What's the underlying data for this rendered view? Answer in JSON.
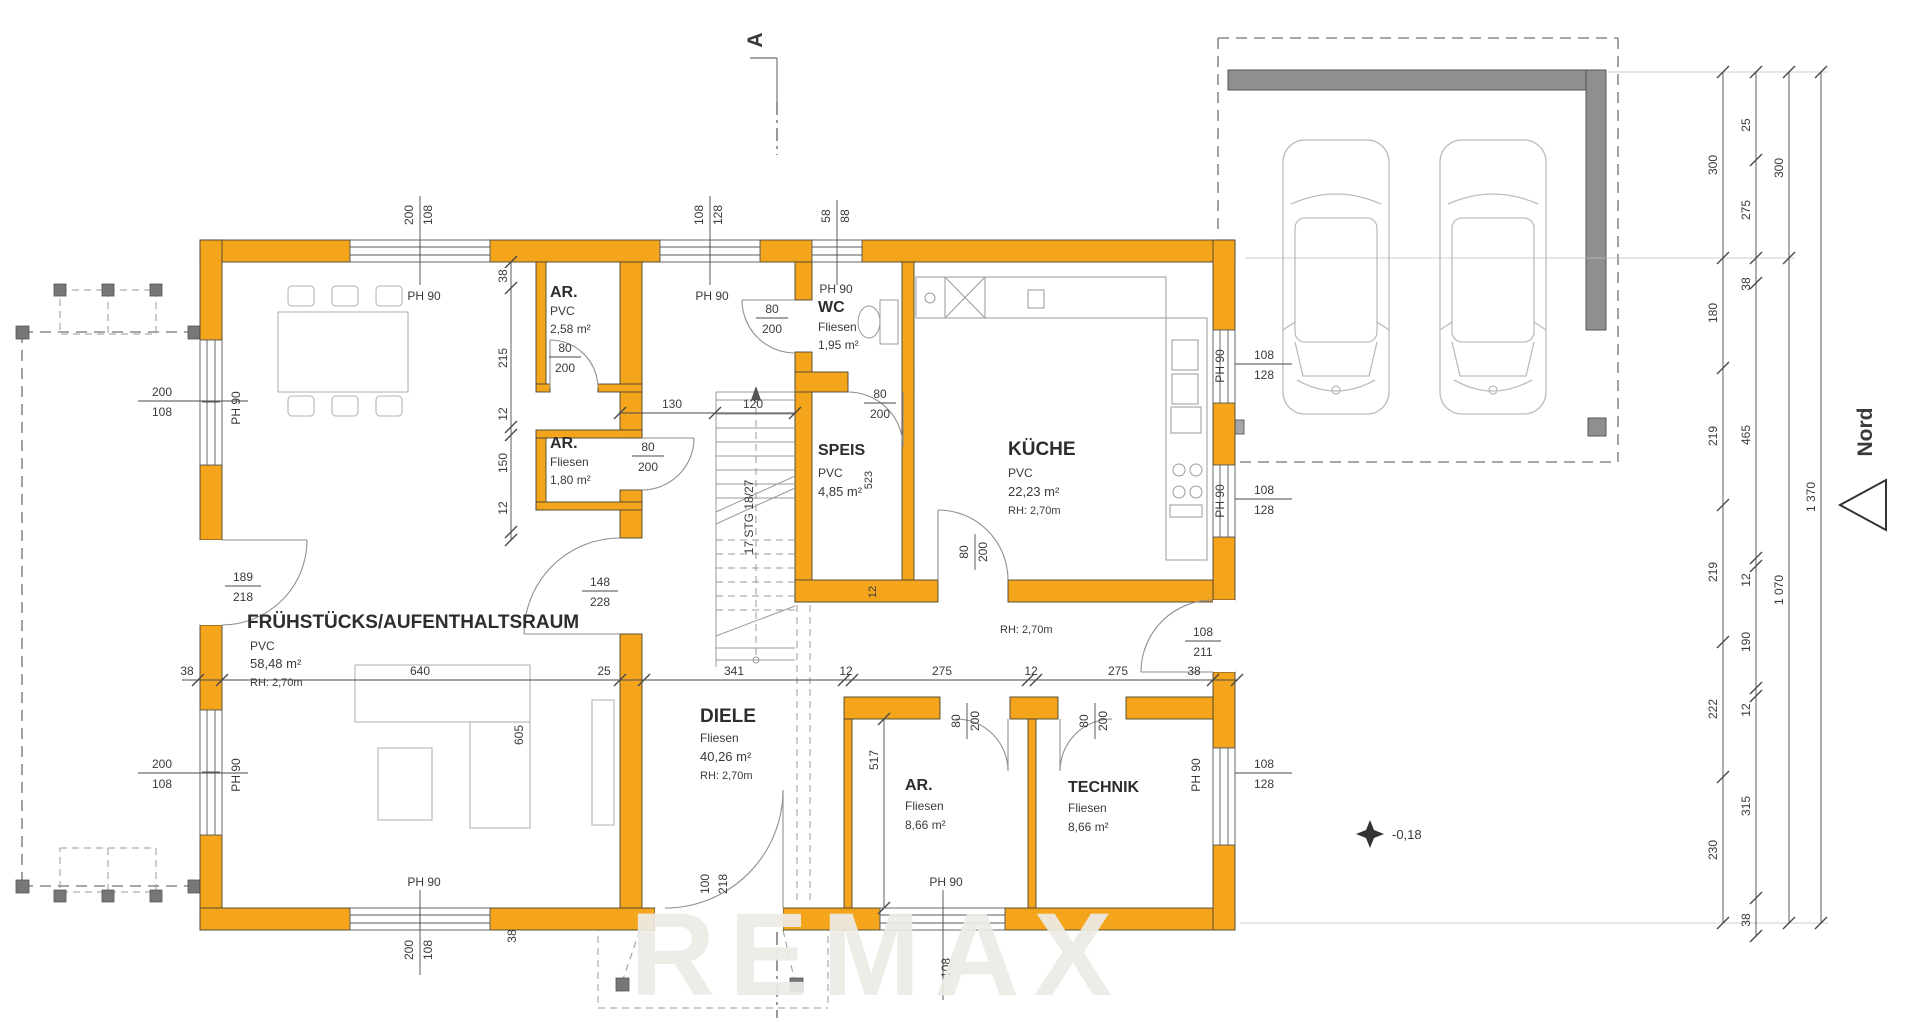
{
  "plan": {
    "section_mark": "A",
    "north_label": "Nord",
    "level_marker": "-0,18",
    "watermark": "REMAX",
    "stair_note": "17 STG 18/27",
    "ph90": "PH 90",
    "rooms": {
      "breakfast": {
        "name": "FRÜHSTÜCKS/AUFENTHALTSRAUM",
        "floor": "PVC",
        "area": "58,48 m²",
        "rh": "RH: 2,70m"
      },
      "diele": {
        "name": "DIELE",
        "floor": "Fliesen",
        "area": "40,26 m²",
        "rh": "RH: 2,70m"
      },
      "kueche": {
        "name": "KÜCHE",
        "floor": "PVC",
        "area": "22,23 m²",
        "rh": "RH: 2,70m"
      },
      "speis": {
        "name": "SPEIS",
        "floor": "PVC",
        "area": "4,85 m²"
      },
      "wc": {
        "name": "WC",
        "floor": "Fliesen",
        "area": "1,95 m²"
      },
      "ar_top": {
        "name": "AR.",
        "floor": "PVC",
        "area": "2,58 m²"
      },
      "ar_mid": {
        "name": "AR.",
        "floor": "Fliesen",
        "area": "1,80 m²"
      },
      "ar_south": {
        "name": "AR.",
        "floor": "Fliesen",
        "area": "8,66 m²"
      },
      "technik": {
        "name": "TECHNIK",
        "floor": "Fliesen",
        "area": "8,66 m²"
      },
      "corridor_rh": "RH: 2,70m"
    },
    "openings": {
      "top_w1": {
        "a": "200",
        "b": "108"
      },
      "top_w2": {
        "a": "108",
        "b": "128"
      },
      "top_w3": {
        "a": "58",
        "b": "88"
      },
      "left_w1": {
        "a": "200",
        "b": "108"
      },
      "left_door": {
        "a": "189",
        "b": "218"
      },
      "left_w2": {
        "a": "200",
        "b": "108"
      },
      "bottom_w1": {
        "a": "200",
        "b": "108"
      },
      "entry_door": {
        "a": "100",
        "b": "218"
      },
      "bottom_w2": {
        "a": "108"
      },
      "right_w1": {
        "a": "108",
        "b": "128"
      },
      "right_w2": {
        "a": "108",
        "b": "128"
      },
      "right_w3": {
        "a": "108",
        "b": "128"
      },
      "garage_door": {
        "a": "108",
        "b": "211"
      },
      "pass_door": {
        "a": "148",
        "b": "228"
      },
      "door_80": {
        "a": "80",
        "b": "200"
      }
    },
    "dims": {
      "mid_chain": [
        "38",
        "640",
        "25",
        "341",
        "12",
        "275",
        "12",
        "275",
        "38"
      ],
      "stair_top": [
        "130",
        "120"
      ],
      "left_inner": [
        "38",
        "215",
        "12",
        "150",
        "12"
      ],
      "v_605": "605",
      "v_517": "517",
      "v_523": "523",
      "v_12": "12",
      "right_chain_1": [
        "300",
        "180",
        "219",
        "219",
        "222",
        "230"
      ],
      "right_chain_2": [
        "25",
        "275",
        "38",
        "465",
        "12",
        "190",
        "12",
        "315",
        "38"
      ],
      "right_chain_3": [
        "300",
        "1 070"
      ],
      "right_chain_4": [
        "1 370"
      ]
    },
    "colors": {
      "wall": "#F4A51B",
      "garage_wall": "#8f8f8f",
      "dim_text": "#3a3a3a"
    }
  }
}
